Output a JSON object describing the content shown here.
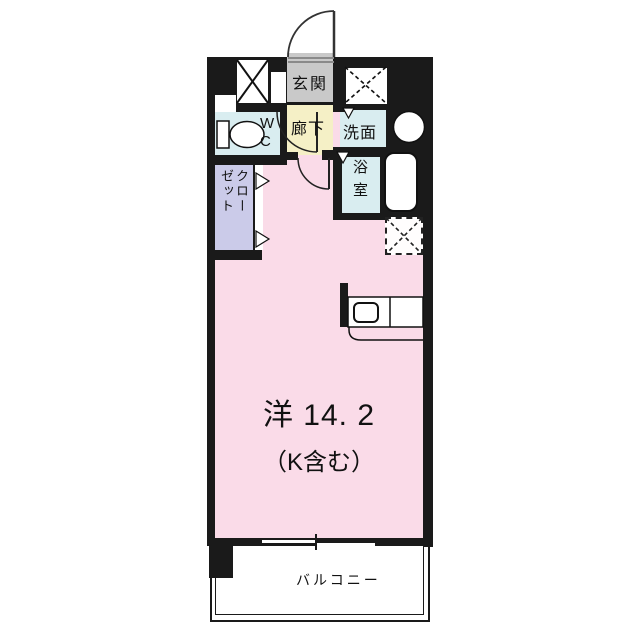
{
  "rooms": {
    "genkan": "玄関",
    "wc": "WC",
    "hallway": "廊下",
    "washroom": "洗面",
    "bathroom": "浴室",
    "closet": "クローゼット",
    "main_room_line1": "洋 14. 2",
    "main_room_line2": "（K含む）",
    "balcony": "バルコニー"
  },
  "fixtures": [
    "entrance-door",
    "toilet",
    "wash-basin",
    "bathtub",
    "kitchen-counter",
    "kitchen-sink",
    "pipe-space",
    "meter-box",
    "refrigerator-space",
    "sliding-window",
    "closet-folding-door",
    "hallway-door",
    "room-door"
  ],
  "colors": {
    "wall": "#1a1a1a",
    "main_room": "#fadbe8",
    "wet_rooms": "#d9edf0",
    "hallway": "#f5f0c6",
    "genkan": "#c9c9c9",
    "closet": "#cbcbe9",
    "balcony": "#ffffff"
  }
}
